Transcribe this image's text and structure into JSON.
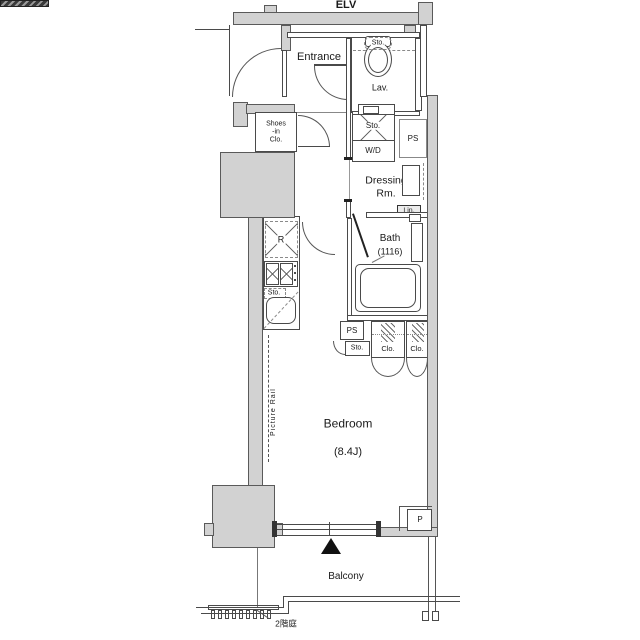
{
  "floorplan": {
    "labels": {
      "elv": "ELV",
      "entrance": "Entrance",
      "lav_sto": "Sto.",
      "lav": "Lav.",
      "shoes1": "Shoes",
      "shoes2": "-in",
      "shoes3": "Clo.",
      "wd_sto": "Sto.",
      "wd": "W/D",
      "ps_top": "PS",
      "dressing1": "Dressing",
      "dressing2": "Rm.",
      "lin": "Lin.",
      "bath": "Bath",
      "bath_size": "(1116)",
      "fridge": "R",
      "kitchen_sto": "Sto.",
      "ps_mid": "PS",
      "sto_mid": "Sto.",
      "clo_left": "Clo.",
      "clo_right": "Clo.",
      "picture_rail": "Picture Rail",
      "bedroom": "Bedroom",
      "bedroom_size": "(8.4J)",
      "p": "P",
      "balcony": "Balcony",
      "garden": "2階庭"
    },
    "colors": {
      "wall_fill": "#d2d2d2",
      "outline": "#4a4a4a",
      "door_leaf": "#3a3a3a",
      "text": "#1a1a1a"
    }
  }
}
